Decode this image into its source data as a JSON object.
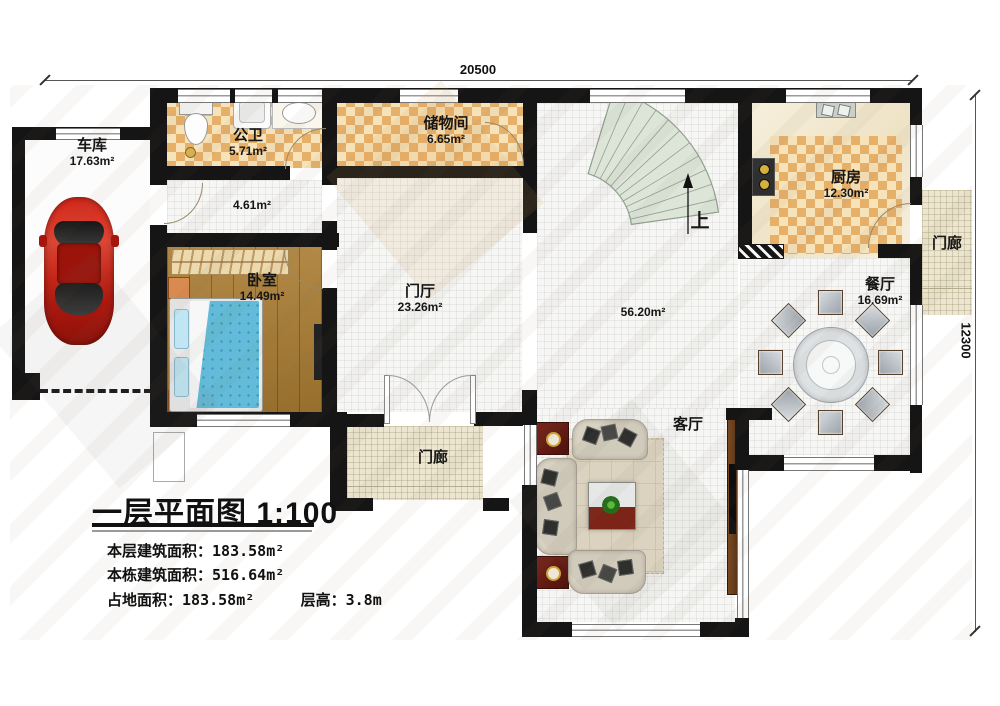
{
  "dimensions": {
    "top": "20500",
    "right": "12300"
  },
  "rooms": {
    "garage": {
      "name": "车库",
      "area": "17.63m²"
    },
    "bathroom": {
      "name": "公卫",
      "area": "5.71m²"
    },
    "storage": {
      "name": "储物间",
      "area": "6.65m²"
    },
    "corridor": {
      "area": "4.61m²"
    },
    "bedroom": {
      "name": "卧室",
      "area": "14.49m²"
    },
    "foyer": {
      "name": "门厅",
      "area": "23.26m²"
    },
    "hall": {
      "area": "56.20m²"
    },
    "kitchen": {
      "name": "厨房",
      "area": "12.30m²"
    },
    "dining": {
      "name": "餐厅",
      "area": "16.69m²"
    },
    "living": {
      "name": "客厅"
    },
    "porch_bottom": {
      "name": "门廊"
    },
    "porch_right": {
      "name": "门廊"
    },
    "stairs": {
      "up": "上"
    }
  },
  "title_block": {
    "title": "一层平面图",
    "scale": "1:100",
    "line1_label": "本层建筑面积：",
    "line1_value": "183.58m²",
    "line2_label": "本栋建筑面积：",
    "line2_value": "516.64m²",
    "line3_label": "占地面积：",
    "line3_value": "183.58m²",
    "line3b_label": "层高：",
    "line3b_value": "3.8m"
  },
  "colors": {
    "wall": "#151515",
    "checker_dark": "#e7b069",
    "checker_light": "#f6e3ba",
    "wood_floor": "#a97b31",
    "car_red": "#c3271a",
    "stairs": "#dde5d9"
  }
}
